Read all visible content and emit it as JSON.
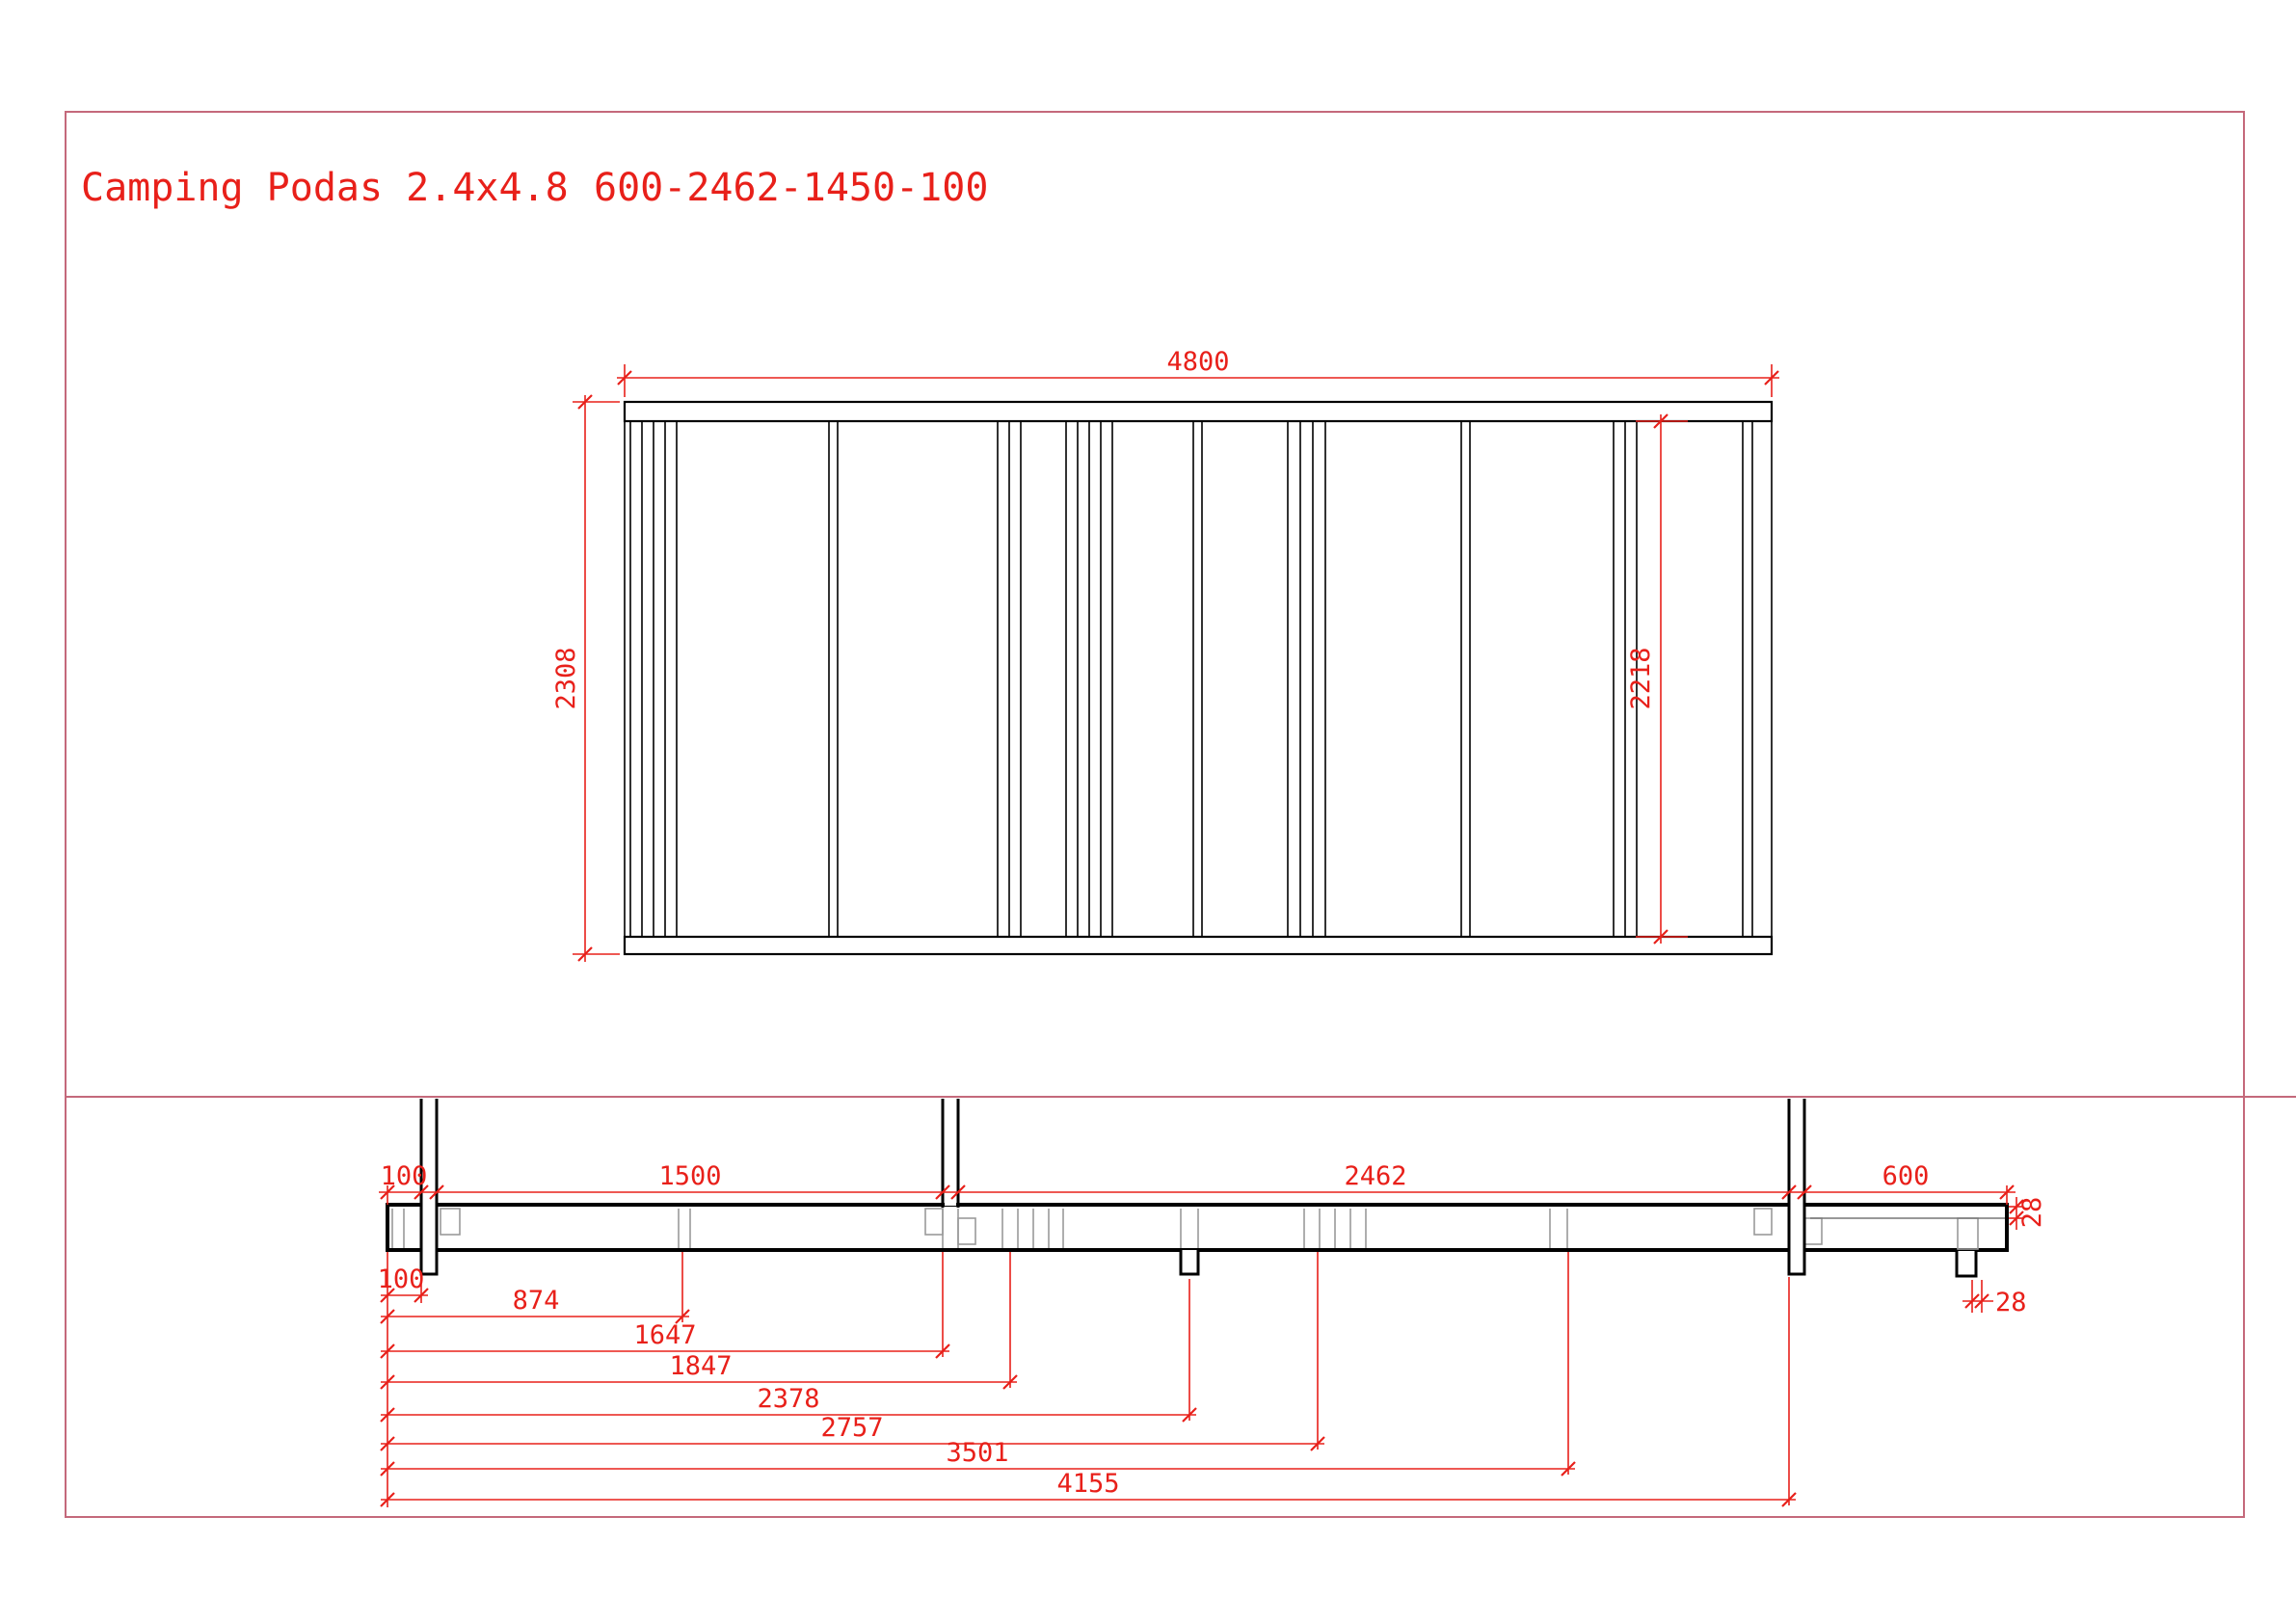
{
  "title": {
    "product": "Camping Podas 2.4x4.8",
    "code": "600-2462-1450-100"
  },
  "colors": {
    "dimension_red": "#e8201a",
    "sheet_border_pink": "#c4697b",
    "drawing_black": "#000000",
    "hidden_gray": "#9a9a9a"
  },
  "top_view": {
    "length": "4800",
    "outer_height": "2308",
    "inner_height": "2218"
  },
  "side_view": {
    "top_chain": [
      "100",
      "1500",
      "2462",
      "600"
    ],
    "deck_thickness": "28",
    "foot_detail": "28",
    "bottom_chain": [
      "100",
      "874",
      "1647",
      "1847",
      "2378",
      "2757",
      "3501",
      "4155"
    ]
  }
}
